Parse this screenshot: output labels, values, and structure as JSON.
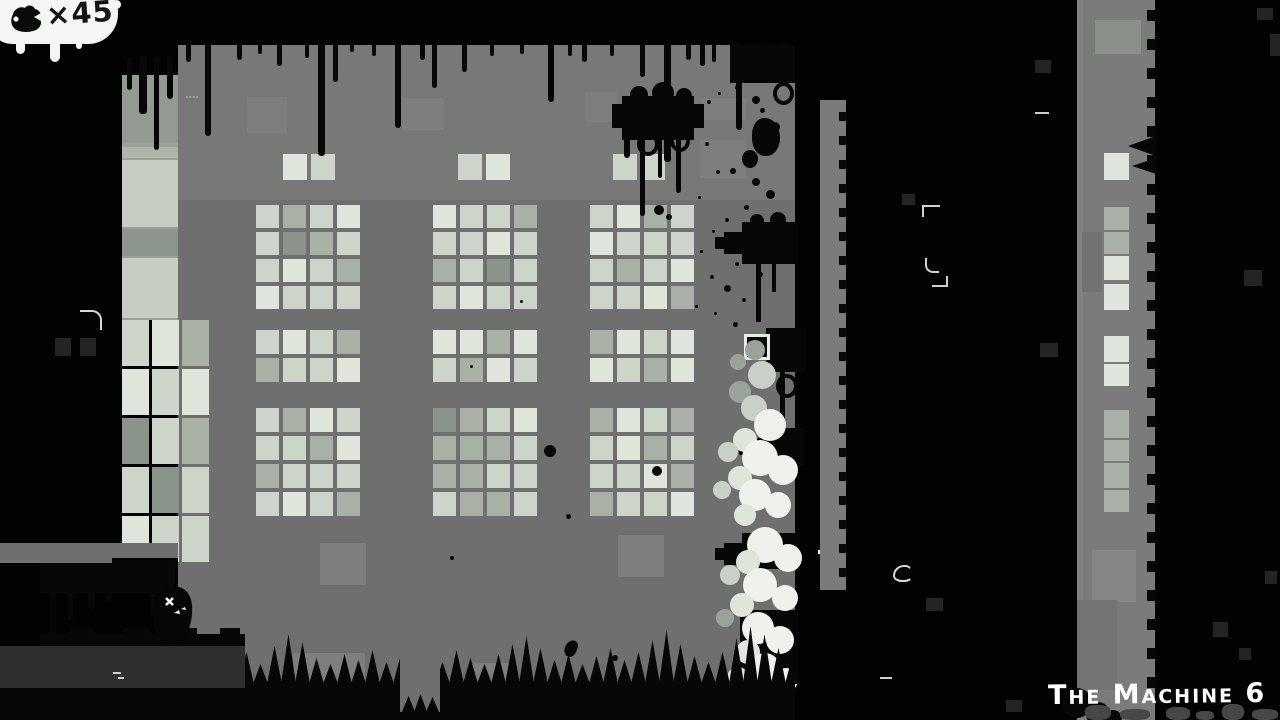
{
  "hud": {
    "collectible_counter": {
      "icon": "tumor-icon",
      "value": "×45"
    },
    "level_label": "The Machine 6"
  },
  "entities": {
    "player_character": "black-blob-with-white-eyes",
    "collectible_icon": "tumor-blob"
  },
  "colors": {
    "background": "#020202",
    "ink_black": "#070707",
    "wall": "#6f6f6f",
    "wall_top_band": "#787878",
    "wall_light_patch": "#7e7e7e",
    "tower_gray": "#7b7b7b",
    "ladder_gray": "#7b7b7b",
    "left_column_base": "#99a198",
    "window_pane_light": "#cdd4ca",
    "window_pane_lighter": "#e0e5dc",
    "window_pane_mid": "#a9b1a6",
    "window_pane_dark": "#8b948a",
    "foam_bubble_bright": "#eef1ec",
    "foam_bubble_light": "#e0e5dc",
    "foam_bubble_mid": "#c9d0c7",
    "foam_bubble_dark": "#9aa39a",
    "void_square": "#242424",
    "ledge_dark": "#2f2f2f",
    "silhouette_gray": "#474747",
    "hud_bubble": "#f3f6f2",
    "counter_text": "#141414",
    "label_text": "#ffffff"
  }
}
